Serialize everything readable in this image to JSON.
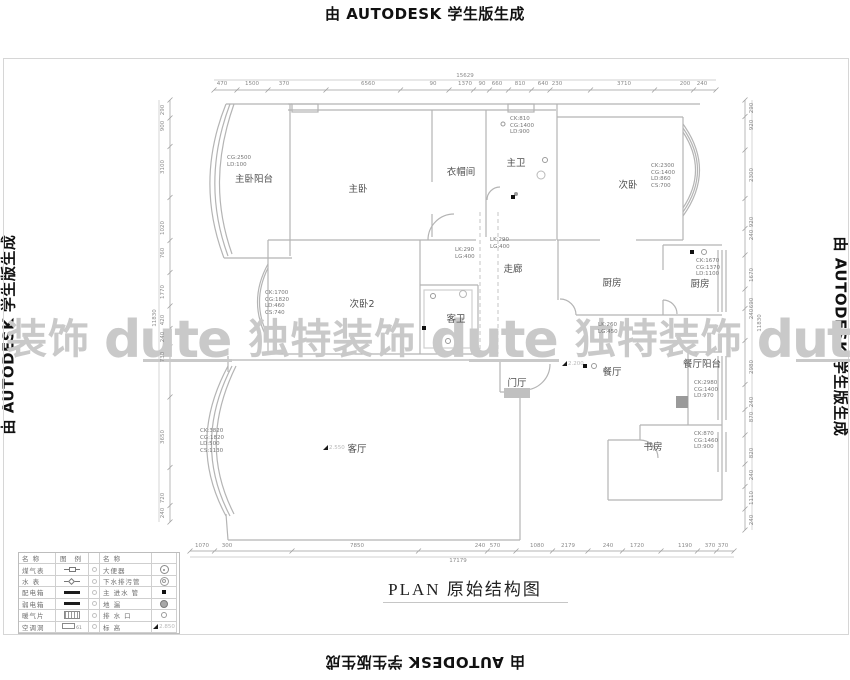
{
  "autodesk_notice": "由 AUTODESK 学生版生成",
  "title": "PLAN  原始结构图",
  "colors": {
    "wall": "#b4b4b4",
    "label": "#4f4f4f",
    "dim": "#8a8a8a",
    "watermark": "#c9c9c9"
  },
  "watermark": {
    "sequence": [
      {
        "type": "cjk",
        "text": "装饰"
      },
      {
        "type": "logo",
        "text": "dute"
      },
      {
        "type": "cjk",
        "text": "独特装饰"
      },
      {
        "type": "logo",
        "text": "dute"
      },
      {
        "type": "cjk",
        "text": "独特装饰"
      },
      {
        "type": "logo",
        "text": "dute"
      },
      {
        "type": "cjk",
        "text": "独特装饰"
      }
    ]
  },
  "plan": {
    "rooms": [
      "主卧阳台",
      "主卧",
      "衣帽间",
      "主卫",
      "次卧",
      "走廊",
      "次卧2",
      "客卫",
      "厨房",
      "厨房",
      "餐厅",
      "餐厅阳台",
      "门厅",
      "客厅",
      "书房"
    ],
    "annotations": [
      [
        "CG:2500",
        "LD:100"
      ],
      [
        "CK:810",
        "CG:1400",
        "LD:900"
      ],
      [
        "CK:2300",
        "CG:1400",
        "LD:860",
        "CS:700"
      ],
      [
        "CK:1700",
        "CG:1820",
        "LD:460",
        "CS:740"
      ],
      [
        "LK:290",
        "LG:400"
      ],
      [
        "LK:290",
        "LG:400"
      ],
      [
        "LK:260",
        "LG:450"
      ],
      [
        "CK:1670",
        "CG:1370",
        "LD:1100"
      ],
      [
        "CK:2980",
        "CG:1400",
        "LD:970"
      ],
      [
        "CK:870",
        "CG:1460",
        "LD:900"
      ],
      [
        "CK:3820",
        "CG:1820",
        "LD:500",
        "CS:1130"
      ]
    ],
    "elevation_markers": [
      "2.550",
      "2.200"
    ],
    "dimensions": {
      "top": {
        "total": "15629",
        "segments": [
          "470",
          "1500",
          "370",
          "6560",
          "90",
          "1370",
          "90",
          "660",
          "810",
          "640",
          "230",
          "3710",
          "200",
          "240"
        ]
      },
      "bottom": {
        "total": "17179",
        "segments": [
          "1070",
          "300",
          "7850",
          "240",
          "570",
          "1080",
          "2179",
          "240",
          "1720",
          "1190",
          "370",
          "370"
        ]
      },
      "left": {
        "total": "11830",
        "segments": [
          "290",
          "900",
          "3100",
          "1020",
          "760",
          "1770",
          "420",
          "240",
          "730",
          "3650",
          "720",
          "240"
        ]
      },
      "right": {
        "total": "11830",
        "segments": [
          "290",
          "920",
          "2300",
          "920",
          "240",
          "1670",
          "690",
          "240",
          "2980",
          "240",
          "870",
          "820",
          "240",
          "1110",
          "240"
        ]
      }
    }
  },
  "legend": {
    "header_name": "名  称",
    "header_symbol": "图  例",
    "left_rows": [
      {
        "name": "煤气表",
        "sym": "gas-meter"
      },
      {
        "name": "水  表",
        "sym": "water-meter"
      },
      {
        "name": "配电箱",
        "sym": "power-box"
      },
      {
        "name": "弱电箱",
        "sym": "lv-box"
      },
      {
        "name": "暖气片",
        "sym": "radiator"
      },
      {
        "name": "空调洞",
        "sym": "ac-hole"
      }
    ],
    "right_rows": [
      {
        "name": "大便器",
        "sym": "toilet"
      },
      {
        "name": "下水排污管",
        "sym": "sewage-pipe"
      },
      {
        "name": "主 进水 管",
        "sym": "main-water-pipe"
      },
      {
        "name": "地  漏",
        "sym": "floor-drain"
      },
      {
        "name": "排 水 口",
        "sym": "drain-outlet"
      },
      {
        "name": "标  高",
        "sym": "elevation"
      }
    ],
    "elevation_value": "2.850"
  }
}
